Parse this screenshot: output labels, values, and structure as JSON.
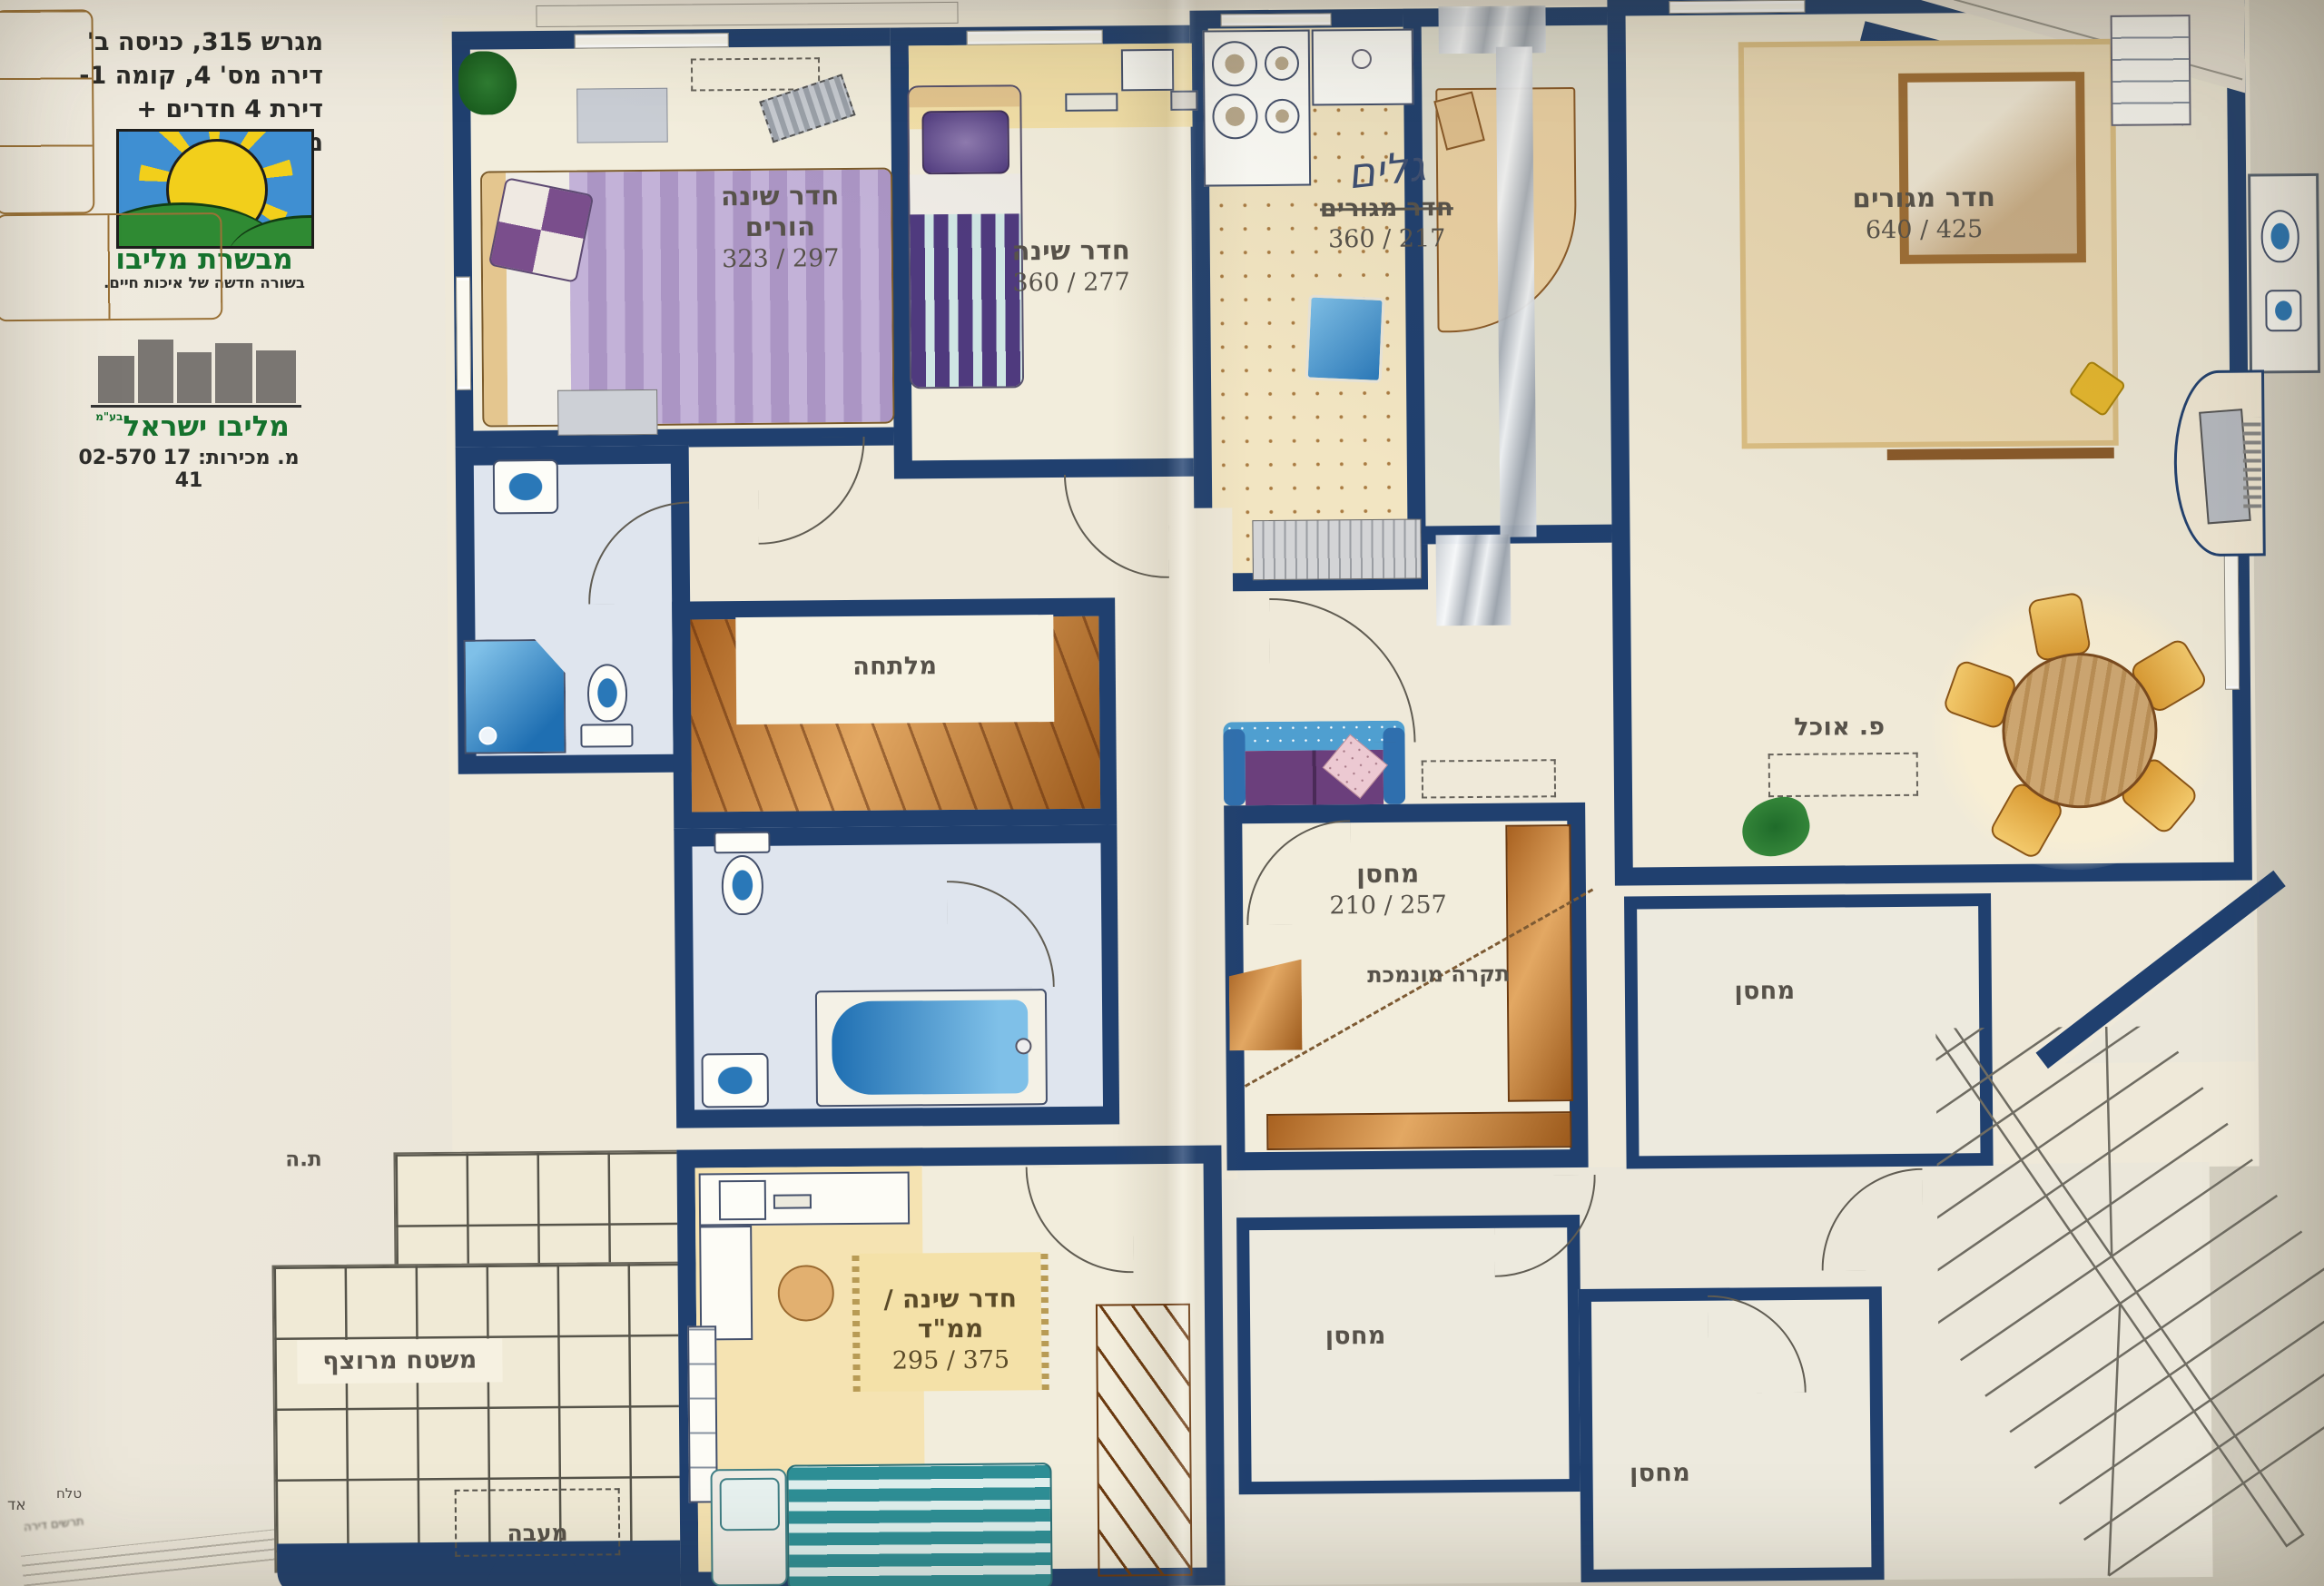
{
  "header": {
    "lines": [
      "מגרש 315, כניסה ב'",
      "דירה מס' 4, קומה 1-",
      "דירת 4 חדרים + מרפסת"
    ]
  },
  "brand_top": {
    "name": "מבשרת מליבו",
    "tagline": "בשורה חדשה של איכות חיים."
  },
  "brand_bottom": {
    "name": "מליבו ישראל",
    "legal": "בע\"מ",
    "sales_label": "מ. מכירות:",
    "phone": "02-570 17 41"
  },
  "rooms": {
    "parents_bedroom": {
      "name": "חדר שינה הורים",
      "dims": "323 / 297"
    },
    "bedroom": {
      "name": "חדר שינה",
      "dims": "360 / 277"
    },
    "den": {
      "handwriting": "גלים",
      "name": "חדר מגורים",
      "dims": "360 / 217"
    },
    "living": {
      "name": "חדר מגורים",
      "dims": "640 / 425"
    },
    "dining": {
      "name": "פ. אוכל"
    },
    "wardrobe": {
      "name": "מלתחה"
    },
    "storage_main": {
      "name": "מחסן",
      "dims": "210 / 257",
      "note": "תקרה מונמכת"
    },
    "safe_room": {
      "name": "חדר שינה / ממ\"ד",
      "dims": "295 / 375"
    },
    "terrace": {
      "name": "משטח מרוצף"
    },
    "condenser": {
      "name": "מעבה"
    },
    "t_h": {
      "name": "ת.ה"
    },
    "storage_a": {
      "name": "מחסן"
    },
    "storage_b": {
      "name": "מחסן"
    },
    "storage_c": {
      "name": "מחסן"
    }
  },
  "footnotes": {
    "edge": "אד",
    "word": "טלח",
    "line": "תרשים דירה"
  },
  "colors": {
    "wall_navy": "#20406f",
    "wood_orange": "#c9873f",
    "paper_cream": "#e9e3d6",
    "fixture_blue": "#2f86c4",
    "brand_green": "#15722d",
    "floor_cream": "#f2eddc",
    "bath_gray_blue": "#dfe5ee",
    "kitchen_tile": "#f4e8c6"
  }
}
